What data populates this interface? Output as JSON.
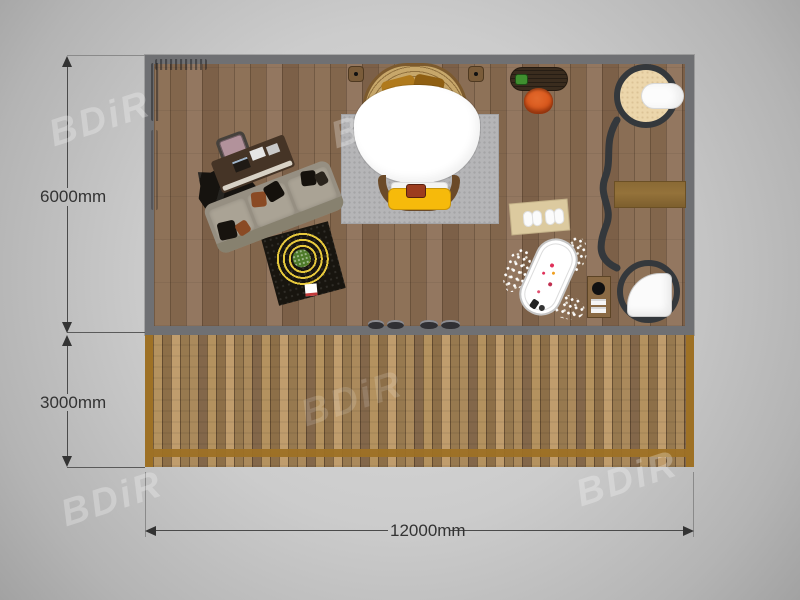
{
  "watermark": {
    "text": "BDiR"
  },
  "dimensions": {
    "interior_depth_label": "6000mm",
    "deck_depth_label": "3000mm",
    "total_width_label": "12000mm"
  },
  "colors": {
    "wall": "#6f7073",
    "interior_floor": "#8a6e55",
    "deck_floor": "#ab8b5e",
    "deck_border": "#9e7125",
    "partition": "#34383c",
    "bed_bench_yellow": "#f6ba0b",
    "stool_orange": "#d8571c",
    "rug_spiral_yellow": "#e6c83c",
    "vanity_floor": "#ecd6ab",
    "dimension_text": "#333333"
  },
  "areas": [
    {
      "name": "interior-room",
      "depth": "6000mm"
    },
    {
      "name": "deck",
      "depth": "3000mm"
    }
  ],
  "furniture": [
    "office-chair",
    "office-desk",
    "cowhide-rug",
    "sectional-sofa",
    "spiral-rug",
    "round-bed",
    "bed-rug",
    "bed-bench",
    "wall-sconce-left",
    "wall-sconce-right",
    "console-table",
    "stool",
    "bath-mat",
    "bathtub",
    "pebble-border",
    "side-caddy",
    "partition-wall",
    "vanity-circle",
    "sink",
    "wall-bench",
    "shower-circle",
    "shower-tray",
    "threshold-slippers"
  ]
}
